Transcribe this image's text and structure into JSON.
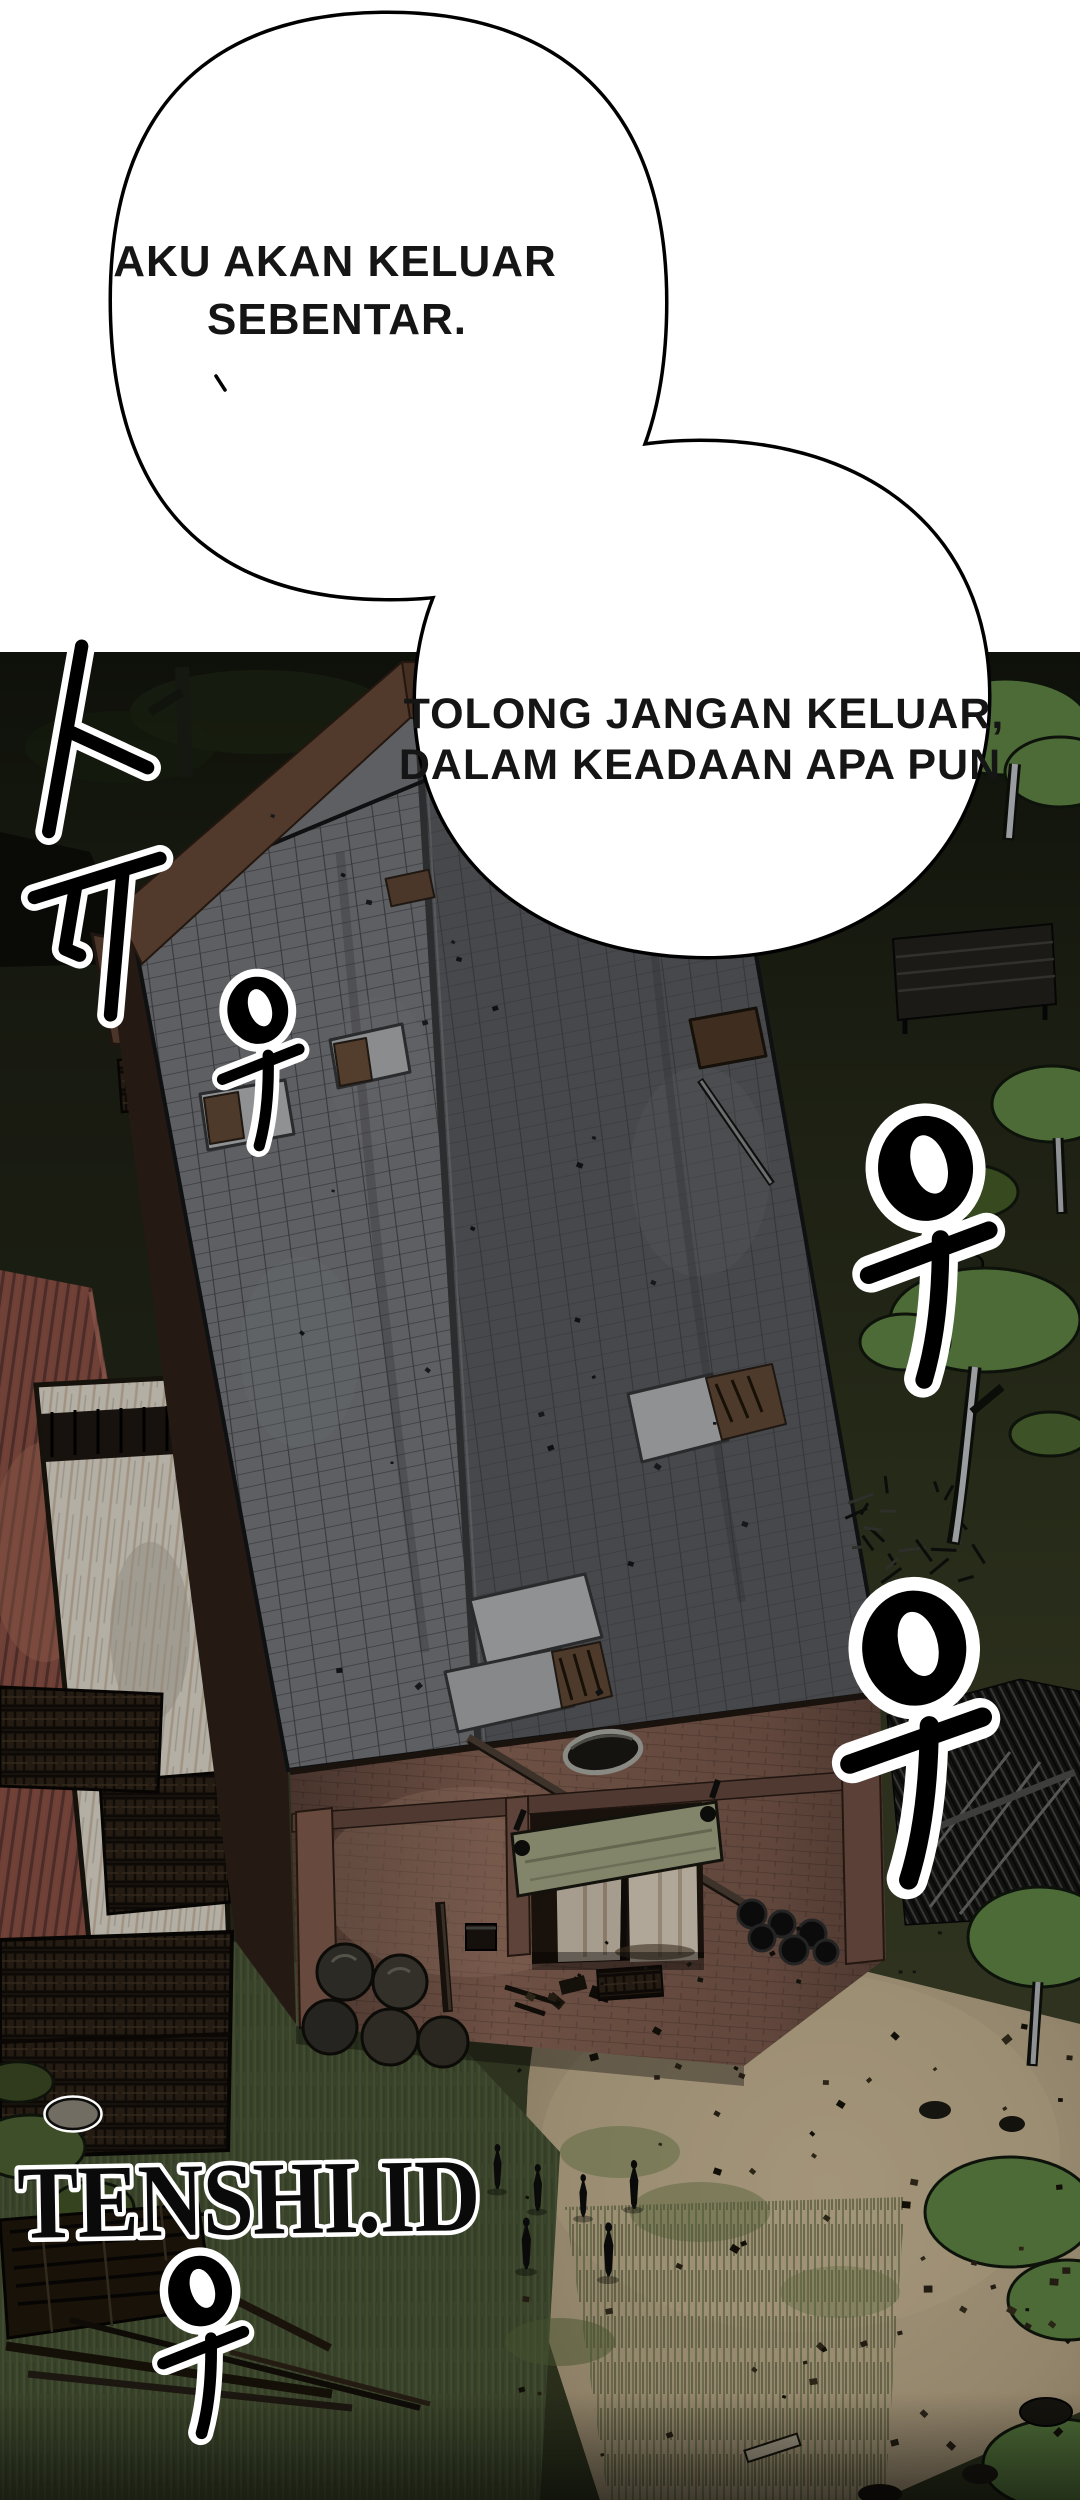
{
  "panel": {
    "type": "webtoon-comic-panel",
    "bubbles": [
      {
        "id": "bubble-1",
        "lines": [
          "AKU AKAN KELUAR",
          "SEBENTAR."
        ]
      },
      {
        "id": "bubble-2",
        "lines": [
          "TOLONG JANGAN KELUAR,",
          "DALAM KEADAAN APA PUN"
        ]
      }
    ],
    "sfx": [
      {
        "id": "sfx-vertical-1",
        "text": "ㅏㅠ"
      },
      {
        "id": "sfx-u-1",
        "text": "우"
      },
      {
        "id": "sfx-u-2",
        "text": "우"
      },
      {
        "id": "sfx-u-3",
        "text": "우"
      },
      {
        "id": "sfx-u-4",
        "text": "우"
      }
    ],
    "watermark": {
      "text": "TENSHI.ID"
    },
    "palette": {
      "page_bg": "#ffffff",
      "ink": "#000000",
      "bubble_fill": "#ffffff",
      "bubble_text": "#151515",
      "sfx_fill": "#000000",
      "sfx_casing": "#ffffff",
      "watermark_fill": "#0a0a0a",
      "watermark_casing": "#ffffff",
      "scene_dark": "#14160d",
      "ground_olive": "#2b2f1c",
      "ground_tan": "#94866c",
      "roof_light": "#5d5f62",
      "roof_dark": "#47484b",
      "brick": "#6e5044",
      "red_roof": "#6e4037",
      "strip_gray": "#b3afa5",
      "foliage": "#4d6b37",
      "door_panel": "#83856b"
    }
  }
}
